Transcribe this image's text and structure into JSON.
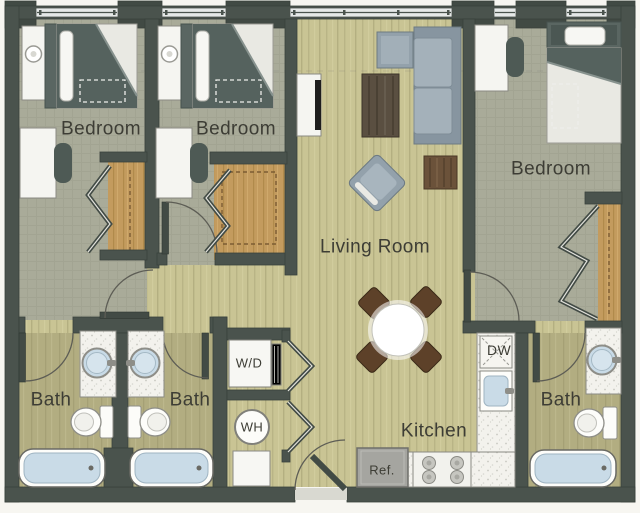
{
  "floor_plan": {
    "rooms": {
      "bedroom_left": {
        "label": "Bedroom"
      },
      "bedroom_middle": {
        "label": "Bedroom"
      },
      "bedroom_right": {
        "label": "Bedroom"
      },
      "living_room": {
        "label": "Living Room"
      },
      "kitchen": {
        "label": "Kitchen"
      },
      "bath_left": {
        "label": "Bath"
      },
      "bath_middle": {
        "label": "Bath"
      },
      "bath_right": {
        "label": "Bath"
      }
    },
    "appliances": {
      "washer_dryer": {
        "label": "W/D"
      },
      "water_heater": {
        "label": "WH"
      },
      "dishwasher": {
        "label": "DW"
      },
      "refrigerator": {
        "label": "Ref."
      }
    },
    "colors": {
      "wall": "#4a534d",
      "wood_floor": "#c9c494",
      "carpet": "#a9ab99",
      "bath_floor": "#b2ad81",
      "closet_floor": "#c39b5e",
      "counter": "#f3f2ed",
      "water": "#c9dbe7",
      "sofa": "#9aa8b2",
      "dark_wood": "#5d4129",
      "label_text": "#3d3d35"
    }
  }
}
